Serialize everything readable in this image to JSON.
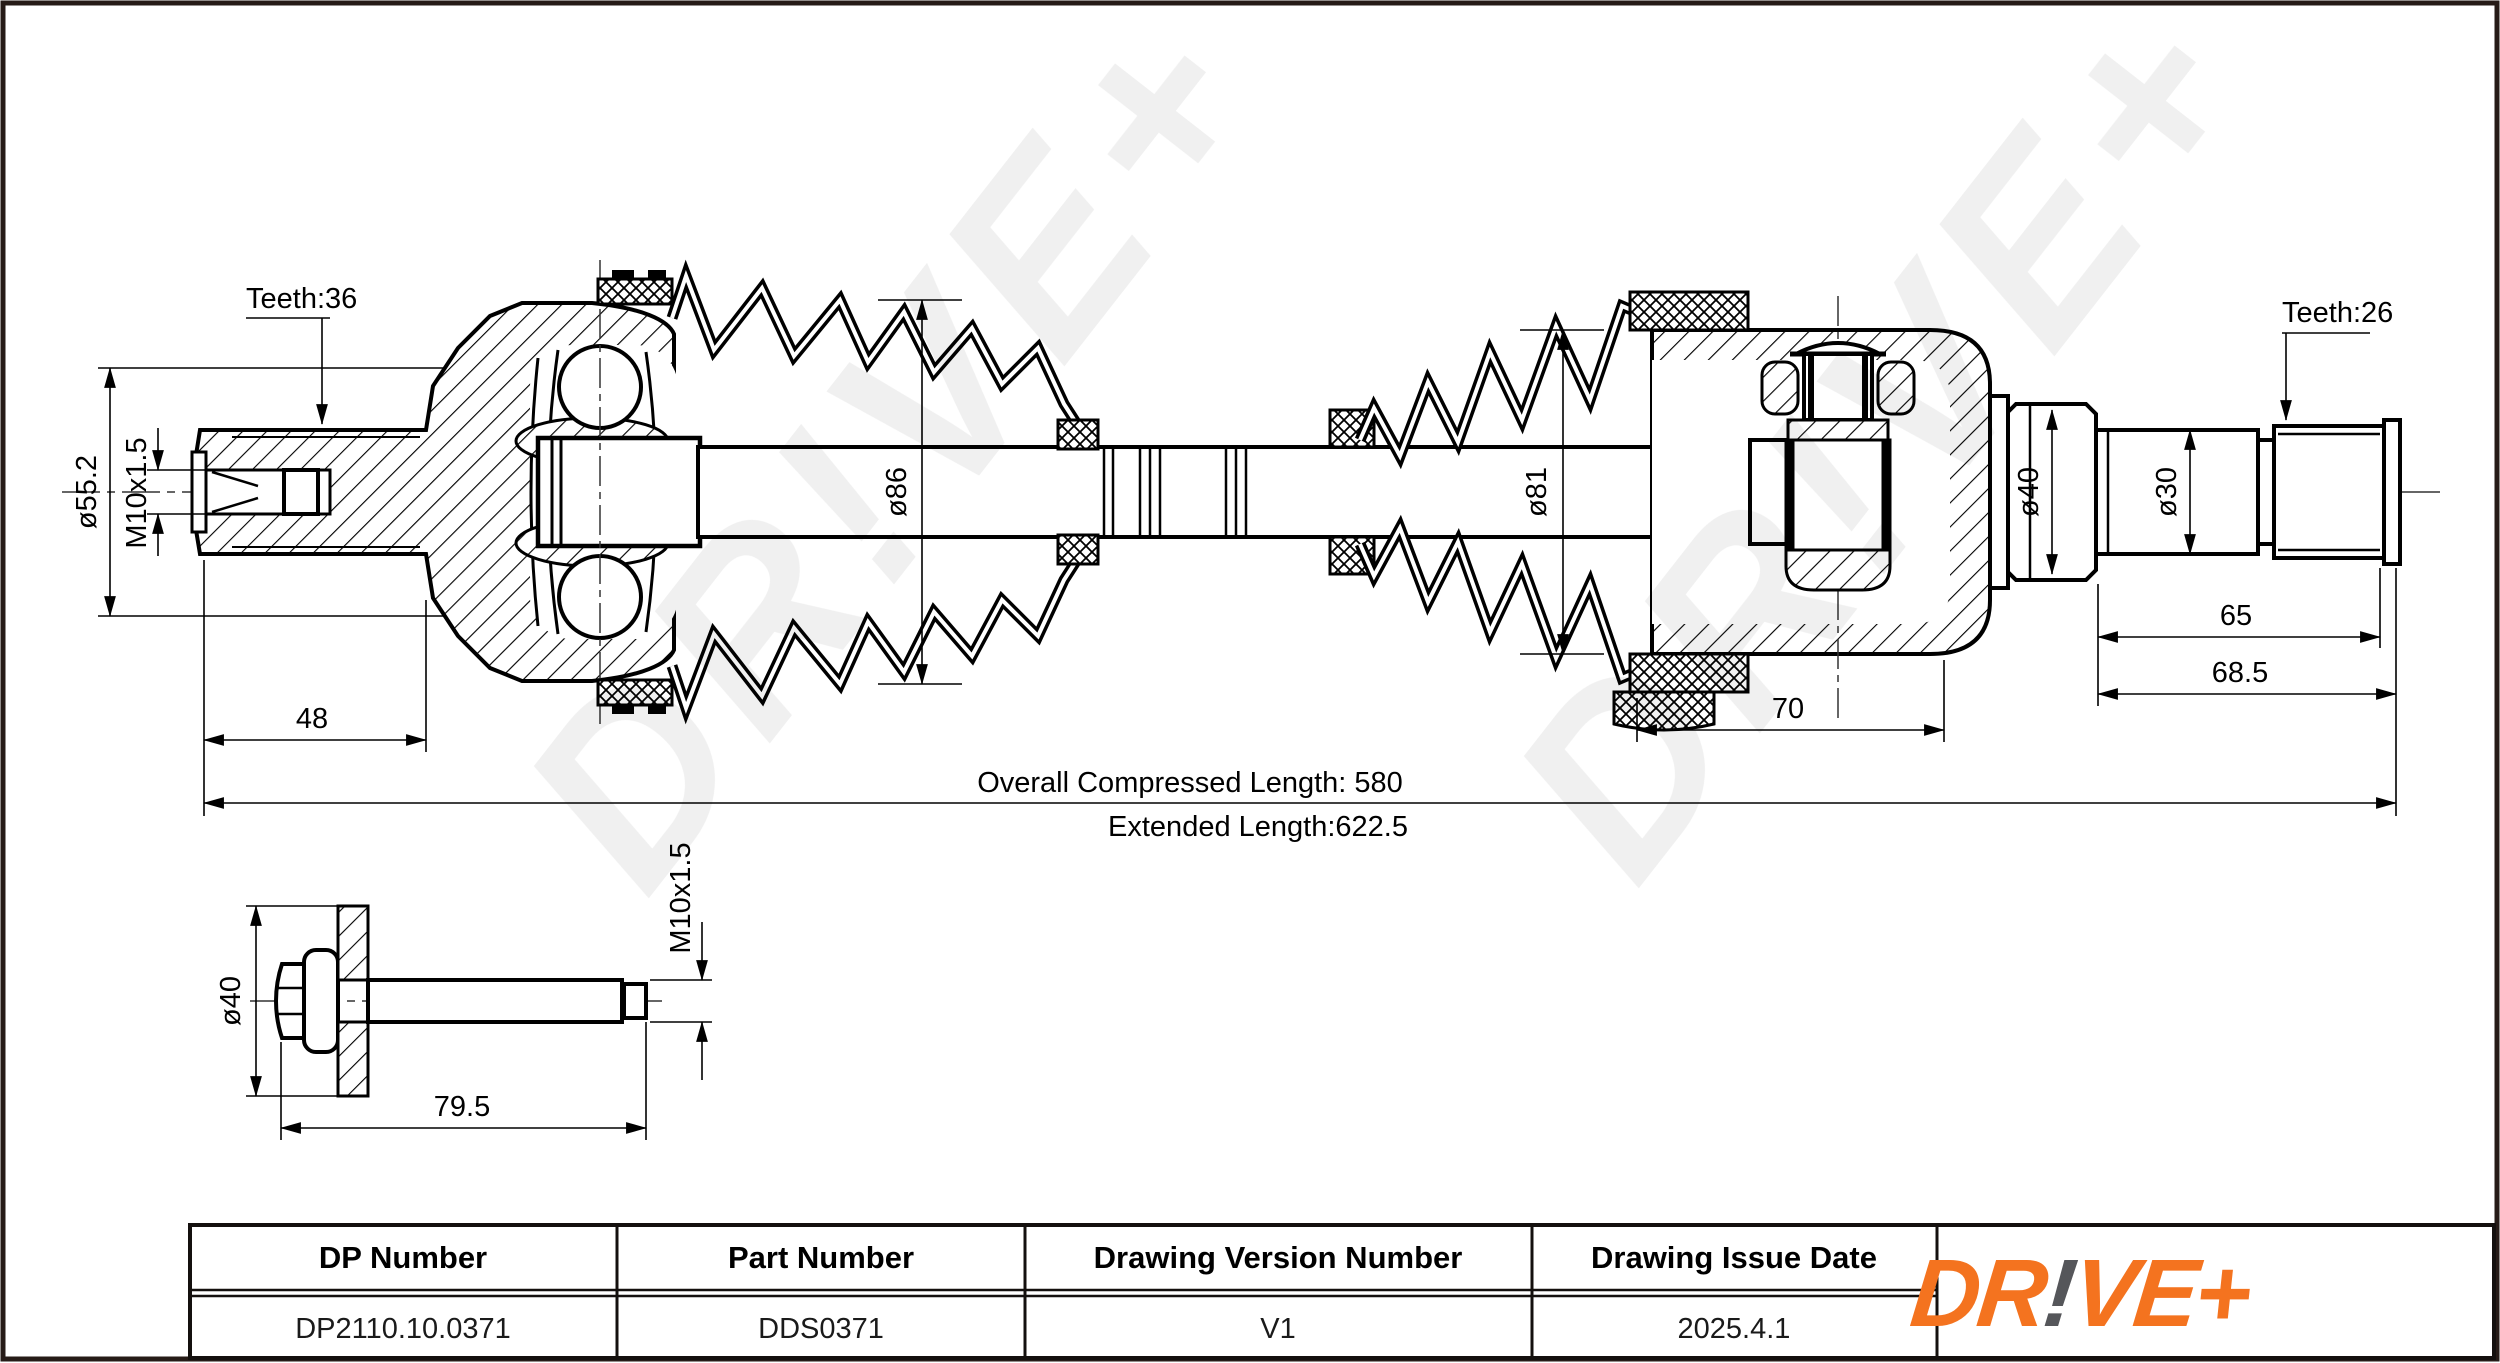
{
  "drawing": {
    "annotations": {
      "teeth_left": "Teeth:36",
      "teeth_right": "Teeth:26",
      "dia_55_2": "ø55.2",
      "thread_left": "M10x1.5",
      "dia_86": "ø86",
      "dia_81": "ø81",
      "dia_40_right": "ø40",
      "dia_30": "ø30",
      "len_48": "48",
      "len_65": "65",
      "len_68_5": "68.5",
      "len_70": "70",
      "overall_compressed_length": "Overall Compressed Length: 580",
      "extended_length": "Extended Length:622.5"
    },
    "bolt": {
      "dia_40": "ø40",
      "len_79_5": "79.5",
      "thread": "M10x1.5"
    },
    "watermark_text": "DR!VE+"
  },
  "info_table": {
    "headers": [
      "DP Number",
      "Part Number",
      "Drawing Version Number",
      "Drawing Issue Date"
    ],
    "values": [
      "DP2110.10.0371",
      "DDS0371",
      "V1",
      "2025.4.1"
    ]
  },
  "logo": {
    "dr": "DR",
    "bang": "!",
    "ve_plus": "VE+",
    "orange": "#F4731F",
    "gray": "#55565A"
  }
}
